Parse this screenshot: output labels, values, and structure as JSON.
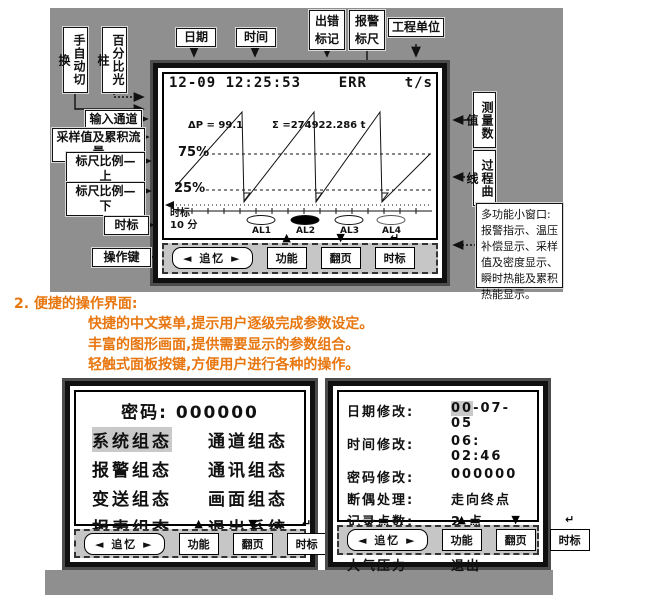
{
  "callouts": {
    "manual_auto": "手自动切换",
    "percent_bar": "百分比光柱",
    "date": "日期",
    "time": "时间",
    "err_mark": "出错标记",
    "alarm_scale": "报警标尺",
    "eng_unit": "工程单位",
    "input_channel": "输入通道",
    "sample_flow": "采样值及累积流量",
    "scale_upper": "标尺比例—上",
    "scale_lower": "标尺比例—下",
    "time_mark": "时标",
    "op_keys": "操作键",
    "meas_value": "测量数值",
    "process_curve": "过程曲线",
    "multi_window": "多功能小窗口:报警指示、温压补偿显示、采样值及密度显示、瞬时热能及累积热能显示。"
  },
  "screen1": {
    "header": {
      "datetime": "12-09 12:25:53",
      "err": "ERR",
      "unit": "t/s"
    },
    "readings": {
      "dp": "ΔP = 99.1",
      "sigma": "Σ =274922.286   t"
    },
    "scale": {
      "upper": "75%",
      "lower": "25%"
    },
    "timebase": {
      "label": "时标",
      "value": "10 分"
    },
    "alarms": [
      {
        "label": "AL1",
        "fill": "#ffffff"
      },
      {
        "label": "AL2",
        "fill": "#000000"
      },
      {
        "label": "AL3",
        "fill": "#ffffff"
      },
      {
        "label": "AL4",
        "fill": "#ffffff"
      }
    ]
  },
  "keypad": {
    "left": "◄",
    "right": "►",
    "recall": "追忆",
    "func": "功能",
    "page": "翻页",
    "tb": "时标",
    "up": "▲",
    "down": "▼",
    "enter": "↵"
  },
  "section": {
    "number": "2.",
    "title": "便捷的操作界面:",
    "line1": "快捷的中文菜单,提示用户逐级完成参数设定。",
    "line2": "丰富的图形画面,提供需要显示的参数组合。",
    "line3": "轻触式面板按键,方便用户进行各种的操作。"
  },
  "screen2": {
    "password_label": "密码:",
    "password_value": "000000",
    "menu": [
      [
        "系统组态",
        "通道组态"
      ],
      [
        "报警组态",
        "通讯组态"
      ],
      [
        "变送组态",
        "画面组态"
      ],
      [
        "报表组态",
        "退出系统"
      ]
    ]
  },
  "screen3": {
    "rows": [
      {
        "label": "日期修改:",
        "hl": "00",
        "value": "-07-05"
      },
      {
        "label": "时间修改:",
        "value": "06: 02:46"
      },
      {
        "label": "密码修改:",
        "value": "000000"
      },
      {
        "label": "断偶处理:",
        "value": "走向终点"
      },
      {
        "label": "记录点数:",
        "value": "2 点"
      },
      {
        "label": "时标选择:",
        "value": "1 类"
      },
      {
        "label": "大气压力",
        "value": "退出"
      }
    ]
  },
  "colors": {
    "accent_orange": "#e8760f",
    "panel_gray": "#8f8f8f",
    "highlight_gray": "#c9c9c9"
  }
}
